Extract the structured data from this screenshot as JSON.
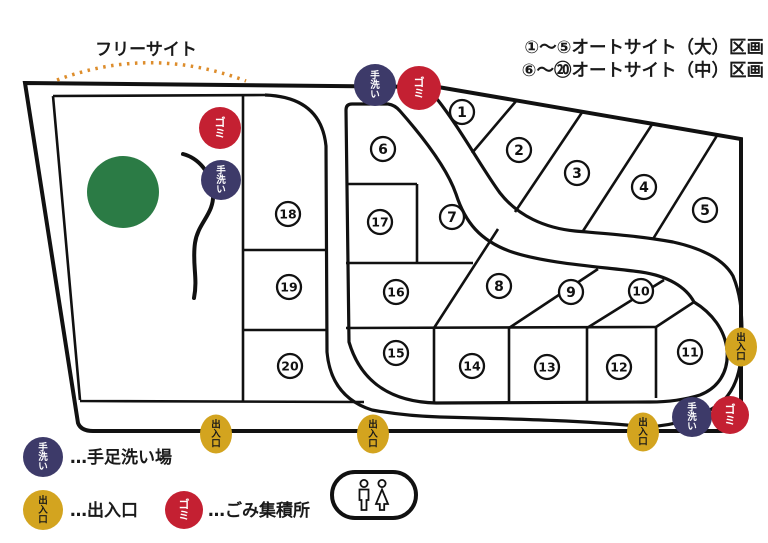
{
  "free_site_label": "フリーサイト",
  "legend_top": {
    "line1": "①～⑤オートサイト（大）区画",
    "line2": "⑥～⑳オートサイト（中）区画"
  },
  "badge_types": {
    "handwash": {
      "label": "手洗い",
      "chars": [
        "手",
        "洗",
        "い"
      ],
      "color": "#3d3a69",
      "text_color": "#ffffff"
    },
    "trash": {
      "label": "ゴミ",
      "chars": [
        "ゴ",
        "ミ"
      ],
      "color": "#c42032",
      "text_color": "#ffffff"
    },
    "exit": {
      "label": "出入口",
      "chars": [
        "出",
        "入",
        "口"
      ],
      "color": "#d3a41f",
      "text_color": "#1a1a1a"
    }
  },
  "legend_bottom": {
    "handwash_text": "…手足洗い場",
    "exit_text": "…出入口",
    "trash_text": "…ごみ集積所"
  },
  "sites": [
    {
      "number": "1"
    },
    {
      "number": "2"
    },
    {
      "number": "3"
    },
    {
      "number": "4"
    },
    {
      "number": "5"
    },
    {
      "number": "6"
    },
    {
      "number": "7"
    },
    {
      "number": "8"
    },
    {
      "number": "9"
    },
    {
      "number": "10"
    },
    {
      "number": "11"
    },
    {
      "number": "12"
    },
    {
      "number": "13"
    },
    {
      "number": "14"
    },
    {
      "number": "15"
    },
    {
      "number": "16"
    },
    {
      "number": "17"
    },
    {
      "number": "18"
    },
    {
      "number": "19"
    },
    {
      "number": "20"
    }
  ],
  "colors": {
    "tree_green": "#2b7b45",
    "arc_orange": "#dd8d2c",
    "line_black": "#111111"
  },
  "icons": {
    "restroom": "restroom-man-woman-icon"
  }
}
